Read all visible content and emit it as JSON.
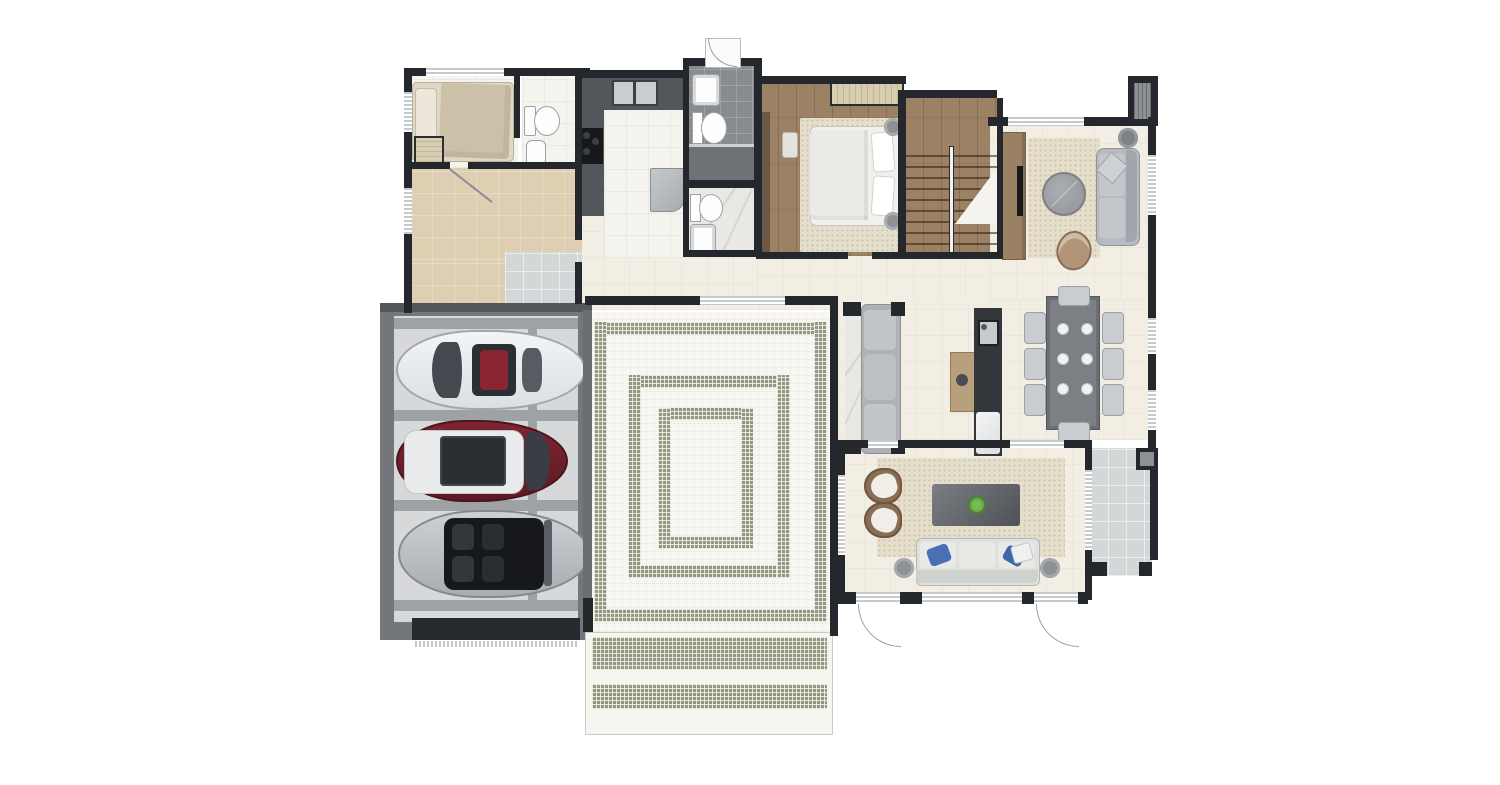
{
  "meta": {
    "title": "House ground-floor plan (top-down architectural rendering)",
    "type": "architectural-floor-plan",
    "text_visible": false
  },
  "palette": {
    "wall": "#24272c",
    "cream": "#f2eee4",
    "white_tile": "#f4f3ee",
    "beige": "#decfb2",
    "gray_tile": "#d4d7d8",
    "wood": "#9d8165",
    "dark_tile": "#898c8f",
    "marble": "#eae8e4",
    "garage_frame": "#73767a",
    "garage_floor": "#d7d8d9",
    "garage_strip": "#9fa2a5",
    "mosaic": "#95977f",
    "rug": "#e5deca",
    "sofa_gray": "#b7bbc1",
    "counter_dark": "#53565b",
    "island_dark": "#33363b",
    "window_frame": "#c7cacd",
    "terrace": "#ccd0d1",
    "car_white": "#e9ebed",
    "car_red": "#6f1f2b",
    "car_silver": "#bfc2c6",
    "chair_brown": "#8a6d52",
    "table_dark": "#6b6e72",
    "plant_green": "#5f9e3f",
    "pillow_blue": "#4a6fb5",
    "wood_cabinet": "#9b8164",
    "bed_linen": "#f1f0ed",
    "blanket": "#cbc0a8"
  },
  "rooms": [
    {
      "name": "guest-bedroom",
      "floor": "white-tile",
      "furniture": [
        "bed",
        "pillow",
        "closet-shelf"
      ]
    },
    {
      "name": "guest-bathroom",
      "floor": "white-tile",
      "furniture": [
        "toilet",
        "sink"
      ]
    },
    {
      "name": "hallway",
      "floor": "beige-tile",
      "furniture": []
    },
    {
      "name": "entry",
      "floor": "gray-tile",
      "furniture": []
    },
    {
      "name": "utility-kitchen",
      "floor": "white-tile",
      "furniture": [
        "double-sink-counter",
        "cooktop",
        "refrigerator"
      ]
    },
    {
      "name": "bathroom-upper",
      "floor": "dark-gray-tile",
      "furniture": [
        "sink",
        "toilet",
        "shower"
      ]
    },
    {
      "name": "bathroom-lower",
      "floor": "marble",
      "furniture": [
        "toilet",
        "sink"
      ]
    },
    {
      "name": "master-bedroom",
      "floor": "wood",
      "furniture": [
        "double-bed",
        "rug",
        "closet",
        "wardrobe",
        "bench",
        "lamp",
        "lamp"
      ]
    },
    {
      "name": "staircase",
      "floor": "wood",
      "furniture": [
        "steps",
        "railing"
      ]
    },
    {
      "name": "sitting-room",
      "floor": "cream-tile",
      "furniture": [
        "tv-cabinet",
        "rug",
        "round-ottoman",
        "sofa",
        "side-table",
        "lounge-chair"
      ]
    },
    {
      "name": "dining-area",
      "floor": "cream-tile",
      "furniture": [
        "banquette-bench",
        "console",
        "kitchen-island",
        "dining-table"
      ]
    },
    {
      "name": "family-room",
      "floor": "cream-tile",
      "furniture": [
        "rug",
        "coffee-table",
        "plant",
        "armchair",
        "armchair",
        "sofa",
        "side-table",
        "side-table"
      ]
    },
    {
      "name": "terrace",
      "floor": "gray-tile",
      "furniture": []
    },
    {
      "name": "courtyard-patio",
      "floor": "white-mosaic",
      "furniture": []
    },
    {
      "name": "garage",
      "floor": "concrete",
      "furniture": []
    }
  ],
  "garage": {
    "cars": [
      {
        "name": "sports-car",
        "color": "white"
      },
      {
        "name": "suv",
        "color": "dark-red-white-roof"
      },
      {
        "name": "convertible",
        "color": "silver"
      }
    ],
    "bays": 3
  },
  "dining": {
    "chairs": 8,
    "place_settings": 6
  },
  "patio": {
    "tile_rings": 3
  },
  "steps": {
    "mosaic_bands": 2
  },
  "fireplace_chimney": 1
}
